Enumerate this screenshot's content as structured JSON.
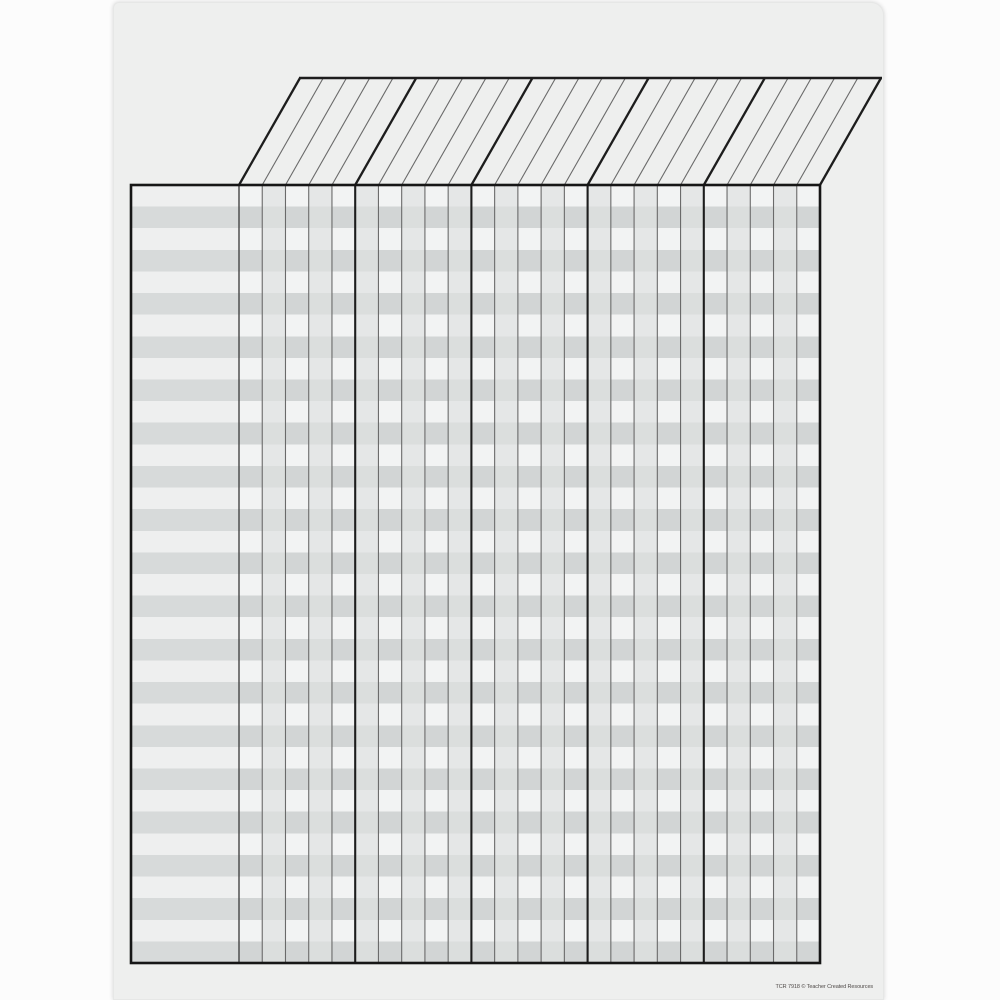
{
  "poster": {
    "footer_text": "TCR 7918 © Teacher Created Resources",
    "background_color": "#eeefee",
    "page_background_color": "#fcfcfc"
  },
  "chart_grid": {
    "type": "blank incentive chart grid",
    "rows": 36,
    "row_stripe_pattern": [
      "light",
      "gray"
    ],
    "name_column": 1,
    "narrow_columns": 25,
    "column_group_size": 5,
    "column_groups": 5,
    "header": {
      "style": "slanted parallelogram",
      "cells": 25,
      "content": ""
    },
    "colors": {
      "row_light_col_light": "#f2f3f3",
      "row_light_col_shade": "#e5e7e7",
      "row_gray_col_light": "#d2d5d5",
      "row_gray_col_shade": "#dbdedd",
      "name_col_row_light": "#eeefef",
      "name_col_row_gray": "#d7dada",
      "header_fill": "#eeefee",
      "line_thin": "#6a6a6a",
      "line_medium": "#454545",
      "line_thick": "#1d1d1d",
      "border": "#161616",
      "footer_text_color": "#4f4a48"
    }
  }
}
